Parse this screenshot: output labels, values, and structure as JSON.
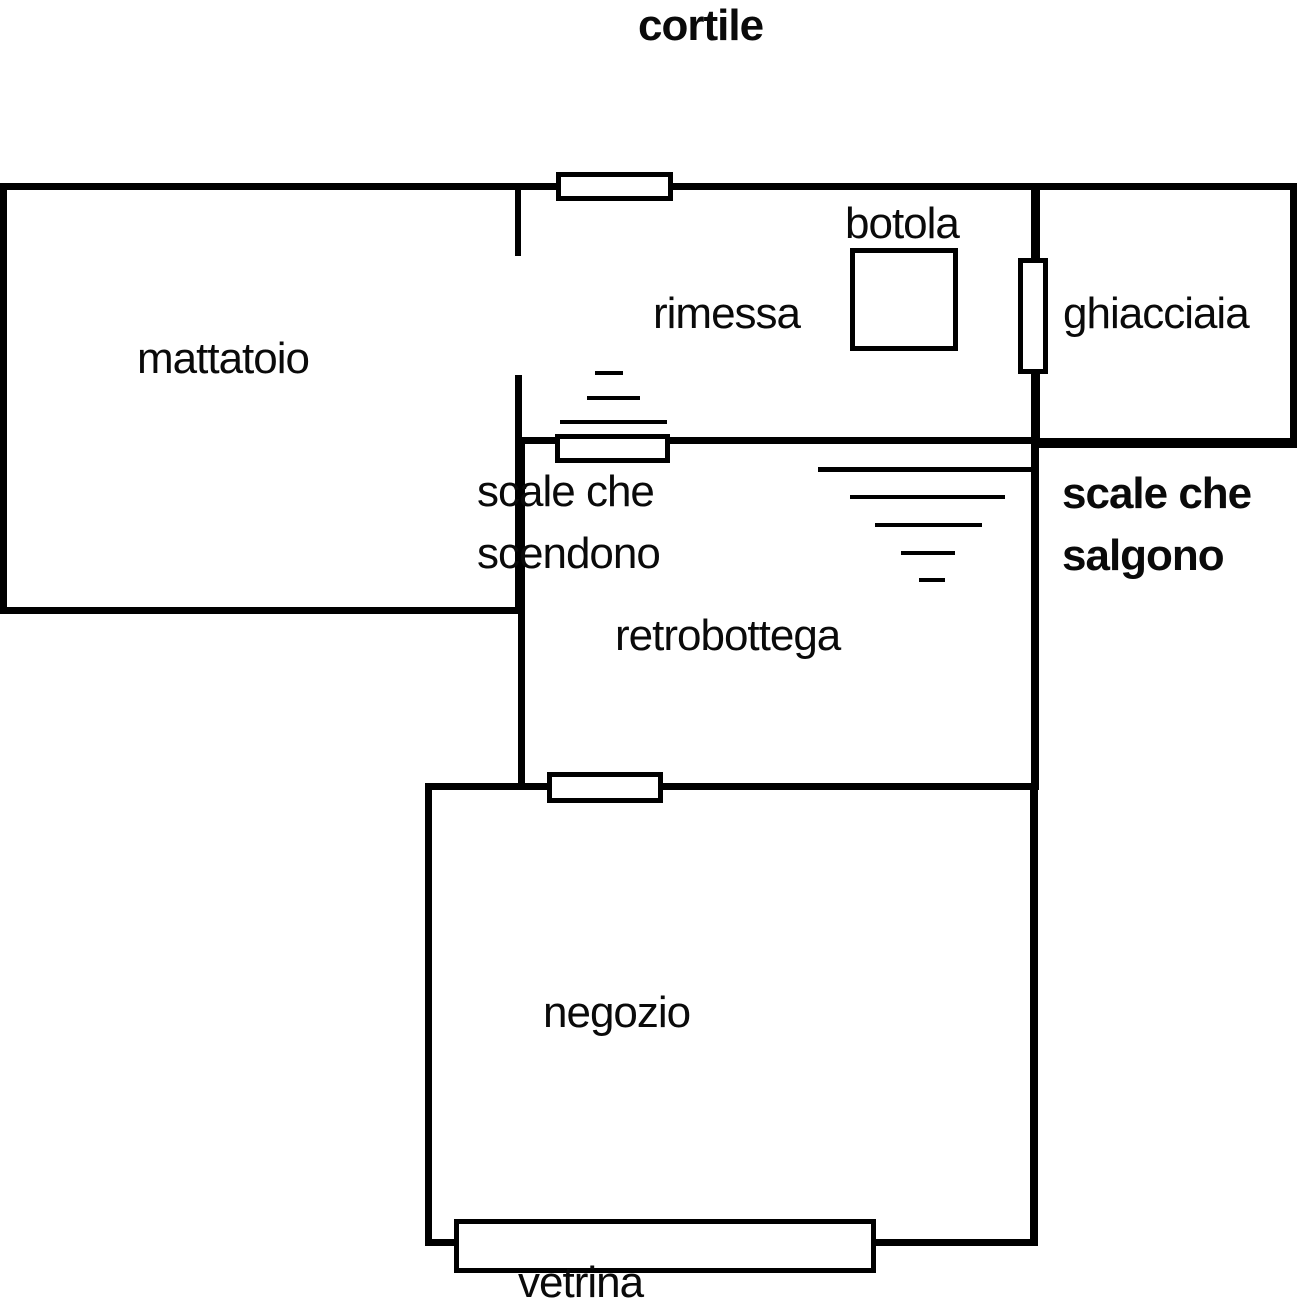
{
  "diagram": {
    "colors": {
      "line": "#000000",
      "background": "#ffffff",
      "text": "#0a0a0a"
    },
    "labels": {
      "cortile": "cortile",
      "mattatoio": "mattatoio",
      "rimessa": "rimessa",
      "botola": "botola",
      "ghiacciaia": "ghiacciaia",
      "scale_scendono_line1": "scale che",
      "scale_scendono_line2": "scendono",
      "scale_salgono_line1": "scale che",
      "scale_salgono_line2": "salgono",
      "retrobottega": "retrobottega",
      "negozio": "negozio",
      "vetrina": "vetrina"
    }
  }
}
